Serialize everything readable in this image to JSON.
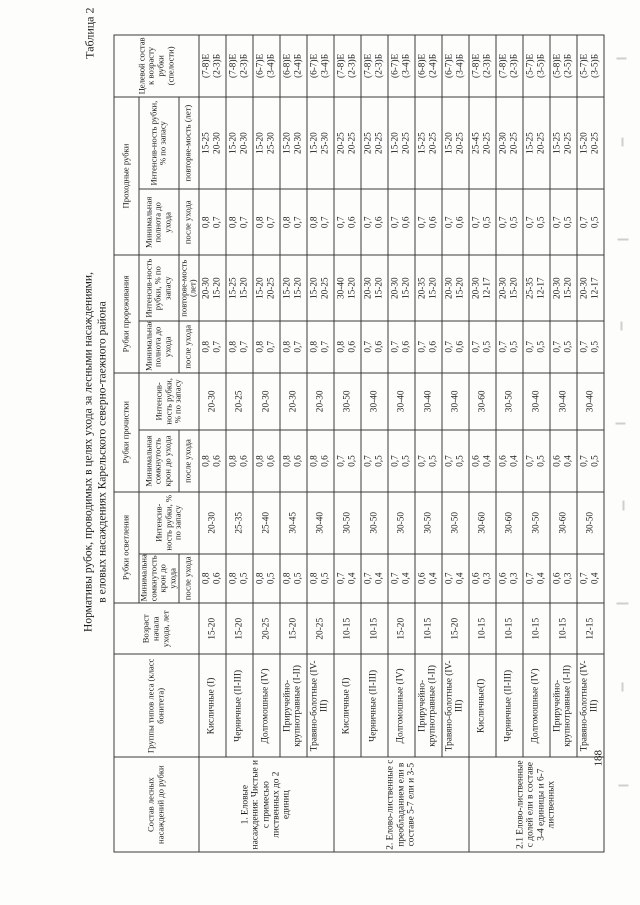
{
  "page": {
    "caption": "Таблица 2",
    "title_line1": "Нормативы рубок, проводимых в целях ухода за лесными насаждениями,",
    "title_line2": "в еловых насаждениях Карельского северно-таежного района",
    "page_number": "188",
    "paper_color": "#fdfdfc",
    "ink_color": "#1c1c1c"
  },
  "table": {
    "header": {
      "composition": "Состав лесных насаждений до рубки",
      "forest_types": "Группы типов леса (класс бонитета)",
      "age": "Возраст начала ухода, лет",
      "group_osvetlenie": "Рубки осветления",
      "group_prochistka": "Рубки прочистки",
      "group_prorezhivanie": "Рубки прореживания",
      "group_prohodnye": "Проходные рубки",
      "min_crown_density": "Минимальная сомкнутость крон до ухода",
      "min_density": "Минимальная полнота до ухода",
      "after_care": "после ухода",
      "intensity": "Интенсив-ность рубки, % по запасу",
      "repeatability": "повторяе-мость (лет)",
      "target": "Целевой состав к возрасту рубки (спелости)"
    },
    "sections": [
      {
        "label": "1. Еловые насаждения: Чистые и с примесью лиственных до 2 единиц",
        "rows": [
          {
            "type": "Кисличные (I)",
            "age": "15-20",
            "osv_d": "0,8\n0,6",
            "osv_i": "20-30",
            "pro_d": "0,8\n0,6",
            "pro_i": "20-30",
            "prz_d": "0,8\n0,7",
            "prz_i": "20-30\n15-20",
            "prh_d": "0,8\n0,7",
            "prh_i": "15-25\n20-30",
            "target": "(7-8)Е\n(2-3)Б"
          },
          {
            "type": "Черничные (II-III)",
            "age": "15-20",
            "osv_d": "0,8\n0,5",
            "osv_i": "25-35",
            "pro_d": "0,8\n0,6",
            "pro_i": "20-25",
            "prz_d": "0,8\n0,7",
            "prz_i": "15-25\n15-20",
            "prh_d": "0,8\n0,7",
            "prh_i": "15-20\n20-30",
            "target": "(7-8)Е\n(2-3)Б"
          },
          {
            "type": "Долгомошные (IV)",
            "age": "20-25",
            "osv_d": "0,8\n0,5",
            "osv_i": "25-40",
            "pro_d": "0,8\n0,6",
            "pro_i": "20-30",
            "prz_d": "0,8\n0,7",
            "prz_i": "15-20\n20-25",
            "prh_d": "0,8\n0,7",
            "prh_i": "15-20\n25-30",
            "target": "(6-7)Е\n(3-4)Б"
          },
          {
            "type": "Приручейно-крупнотравные (I-II)",
            "age": "15-20",
            "osv_d": "0,8\n0,5",
            "osv_i": "30-45",
            "pro_d": "0,8\n0,6",
            "pro_i": "20-30",
            "prz_d": "0,8\n0,7",
            "prz_i": "15-20\n15-20",
            "prh_d": "0,8\n0,7",
            "prh_i": "15-20\n20-30",
            "target": "(6-8)Е\n(2-4)Б"
          },
          {
            "type": "Травяно-болотные (IV-III)",
            "age": "20-25",
            "osv_d": "0,8\n0,5",
            "osv_i": "30-40",
            "pro_d": "0,8\n0,6",
            "pro_i": "20-30",
            "prz_d": "0,8\n0,7",
            "prz_i": "15-20\n20-25",
            "prh_d": "0,8\n0,7",
            "prh_i": "15-20\n25-30",
            "target": "(6-7)Е\n(3-4)Б"
          }
        ]
      },
      {
        "label": "2. Елово-лиственные с преобладанием ели в составе 5-7 ели и 3-5",
        "rows": [
          {
            "type": "Кисличные (I)",
            "age": "10-15",
            "osv_d": "0,7\n0,4",
            "osv_i": "30-50",
            "pro_d": "0,7\n0,5",
            "pro_i": "30-50",
            "prz_d": "0,8\n0,6",
            "prz_i": "30-40\n15-20",
            "prh_d": "0,7\n0,6",
            "prh_i": "20-25\n20-25",
            "target": "(7-8)Е\n(2-3)Б"
          },
          {
            "type": "Черничные (II-III)",
            "age": "10-15",
            "osv_d": "0,7\n0,4",
            "osv_i": "30-50",
            "pro_d": "0,7\n0,5",
            "pro_i": "30-40",
            "prz_d": "0,7\n0,6",
            "prz_i": "20-30\n15-20",
            "prh_d": "0,7\n0,6",
            "prh_i": "20-25\n20-25",
            "target": "(7-8)Е\n(2-3)Б"
          },
          {
            "type": "Долгомошные (IV)",
            "age": "15-20",
            "osv_d": "0,7\n0,4",
            "osv_i": "30-50",
            "pro_d": "0,7\n0,5",
            "pro_i": "30-40",
            "prz_d": "0,7\n0,6",
            "prz_i": "20-30\n15-20",
            "prh_d": "0,7\n0,6",
            "prh_i": "15-20\n20-25",
            "target": "(6-7)Е\n(3-4)Б"
          },
          {
            "type": "Приручейно-крупнотравные (I-II)",
            "age": "10-15",
            "osv_d": "0,6\n0,4",
            "osv_i": "30-50",
            "pro_d": "0,7\n0,5",
            "pro_i": "30-40",
            "prz_d": "0,7\n0,6",
            "prz_i": "20-35\n15-20",
            "prh_d": "0,7\n0,6",
            "prh_i": "15-25\n20-25",
            "target": "(6-8)Е\n(2-4)Б"
          },
          {
            "type": "Травяно-болотные (IV-III)",
            "age": "15-20",
            "osv_d": "0,7\n0,4",
            "osv_i": "30-50",
            "pro_d": "0,7\n0,5",
            "pro_i": "30-40",
            "prz_d": "0,7\n0,6",
            "prz_i": "20-30\n15-20",
            "prh_d": "0,7\n0,6",
            "prh_i": "15-20\n20-25",
            "target": "(6-7)Е\n(3-4)Б"
          }
        ]
      },
      {
        "label": "2.1 Елово-лиственные с долей ели в составе 3-4 единицы и 6-7 лиственных",
        "rows": [
          {
            "type": "Кисличные(I)",
            "age": "10-15",
            "osv_d": "0,6\n0,3",
            "osv_i": "30-60",
            "pro_d": "0,6\n0,4",
            "pro_i": "30-60",
            "prz_d": "0,7\n0,5",
            "prz_i": "20-30\n12-17",
            "prh_d": "0,7\n0,5",
            "prh_i": "25-45\n20-25",
            "target": "(7-8)Е\n(2-3)Б"
          },
          {
            "type": "Черничные (II-III)",
            "age": "10-15",
            "osv_d": "0,6\n0,3",
            "osv_i": "30-60",
            "pro_d": "0,6\n0,4",
            "pro_i": "30-50",
            "prz_d": "0,7\n0,5",
            "prz_i": "20-30\n15-20",
            "prh_d": "0,7\n0,5",
            "prh_i": "20-30\n20-25",
            "target": "(7-8)Е\n(2-3)Б"
          },
          {
            "type": "Долгомошные (IV)",
            "age": "10-15",
            "osv_d": "0,7\n0,4",
            "osv_i": "30-50",
            "pro_d": "0,7\n0,5",
            "pro_i": "30-40",
            "prz_d": "0,7\n0,5",
            "prz_i": "25-35\n12-17",
            "prh_d": "0,7\n0,5",
            "prh_i": "15-25\n20-25",
            "target": "(5-7)Е\n(3-5)Б"
          },
          {
            "type": "Приручейно-крупнотравные (I-II)",
            "age": "10-15",
            "osv_d": "0,6\n0,3",
            "osv_i": "30-60",
            "pro_d": "0,6\n0,4",
            "pro_i": "30-40",
            "prz_d": "0,7\n0,5",
            "prz_i": "20-30\n15-20",
            "prh_d": "0,7\n0,5",
            "prh_i": "15-25\n20-25",
            "target": "(5-8)Е\n(2-5)Б"
          },
          {
            "type": "Травяно-болотные (IV-III)",
            "age": "12-15",
            "osv_d": "0,7\n0,4",
            "osv_i": "30-50",
            "pro_d": "0,7\n0,5",
            "pro_i": "30-40",
            "prz_d": "0,7\n0,5",
            "prz_i": "20-30\n12-17",
            "prh_d": "0,7\n0,5",
            "prh_i": "15-20\n20-25",
            "target": "(5-7)Е\n(3-5)Б"
          }
        ]
      }
    ]
  }
}
